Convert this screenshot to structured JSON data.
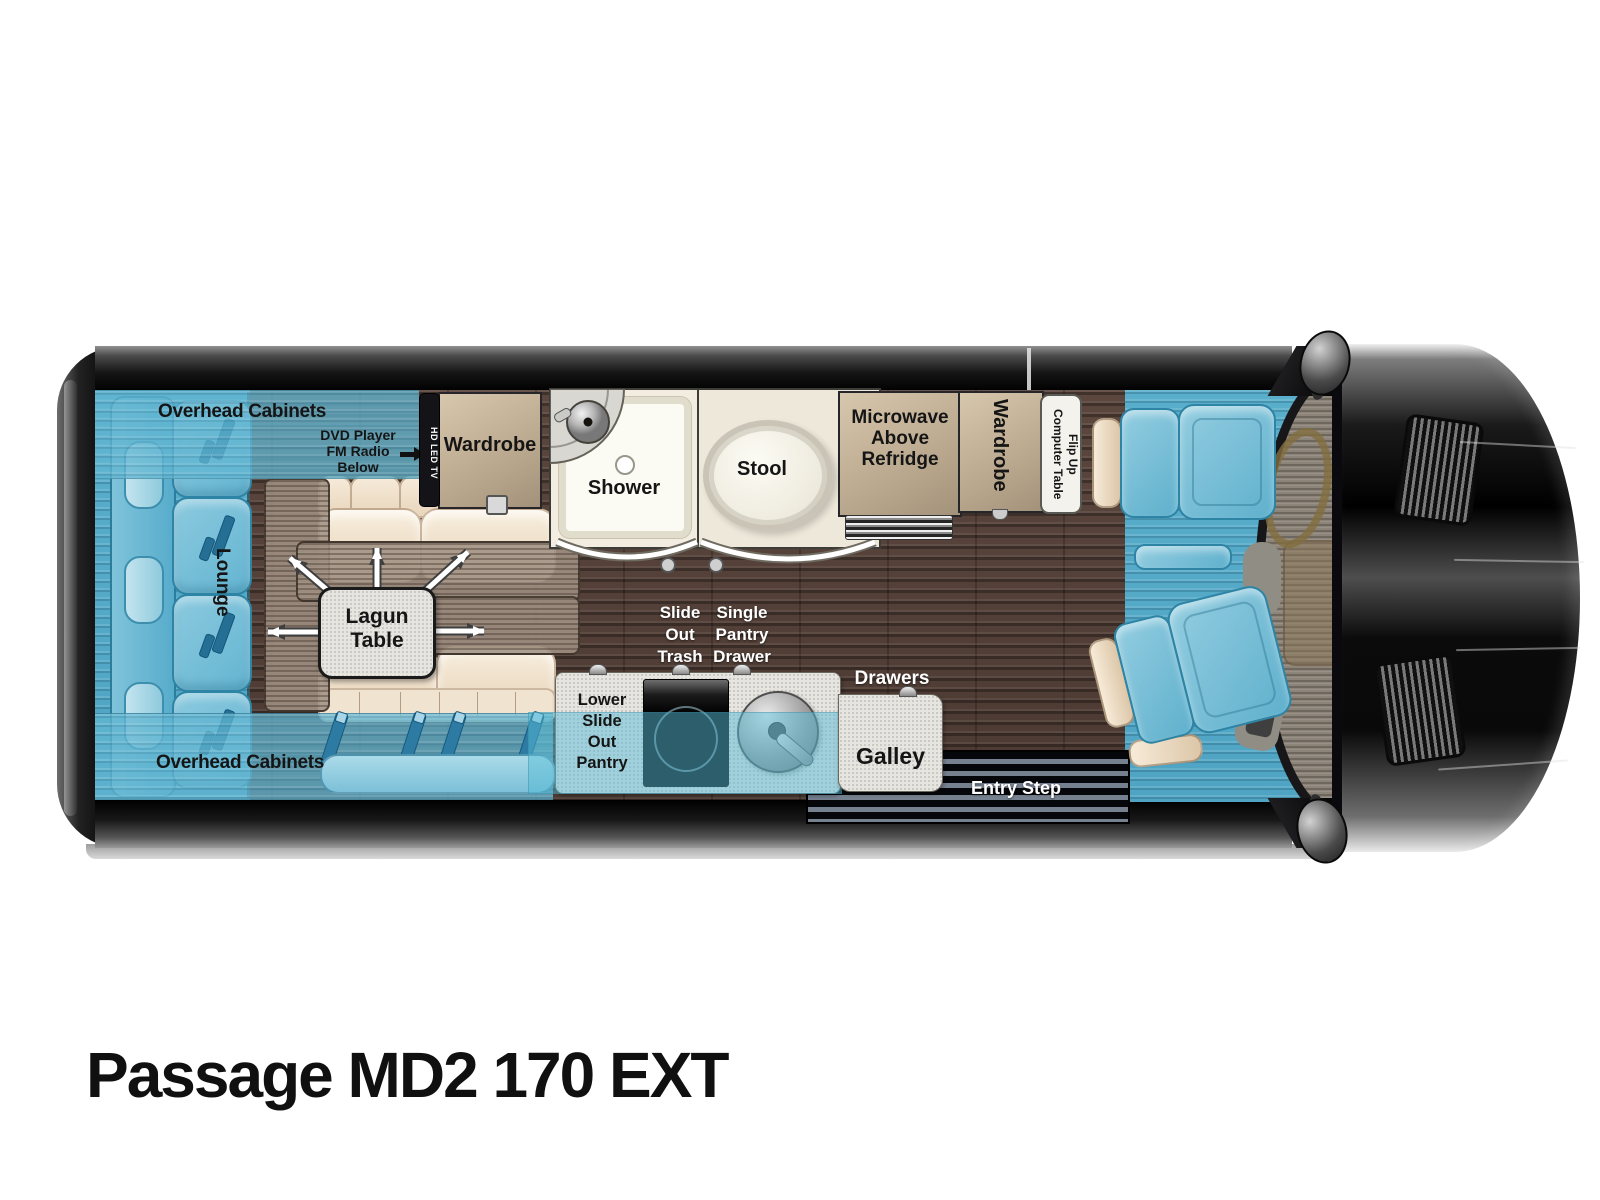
{
  "labels": {
    "title": "Passage MD2 170 EXT",
    "overhead_cabinets_top": "Overhead Cabinets",
    "overhead_cabinets_bottom": "Overhead Cabinets",
    "lounge": "Lounge",
    "dvd": [
      "DVD Player",
      "FM Radio",
      "Below"
    ],
    "tv": "HD LED TV",
    "wardrobe_left": "Wardrobe",
    "lagun": [
      "Lagun",
      "Table"
    ],
    "shower": "Shower",
    "stool": "Stool",
    "fridge": [
      "Microwave",
      "Above",
      "Refridge"
    ],
    "wardrobe_right": "Wardrobe",
    "flip_table": [
      "Flip Up",
      "Computer Table"
    ],
    "slide_out_trash": [
      "Slide",
      "Out",
      "Trash"
    ],
    "single_pantry_drawer": [
      "Single",
      "Pantry",
      "Drawer"
    ],
    "drawers": "Drawers",
    "lower_slide_out_pantry": [
      "Lower",
      "Slide",
      "Out",
      "Pantry"
    ],
    "galley": "Galley",
    "entry_step": "Entry Step"
  },
  "colors": {
    "upholstery_blue": "#63b4d1",
    "floor_wood_brown": "#53403a",
    "cabinet_tan": "#bdab91",
    "cushion_cream": "#f0e3d0",
    "counter_gray": "#e7e5e0",
    "body_black": "#0a0a0a"
  }
}
